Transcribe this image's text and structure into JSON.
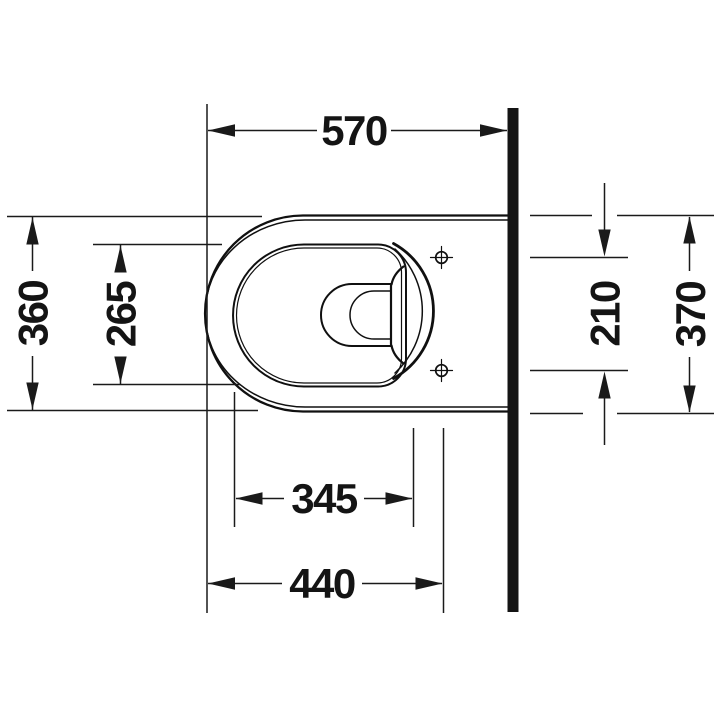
{
  "drawing": {
    "kind": "technical-dimension-drawing",
    "view": "top-view",
    "object": "wall-mounted-toilet"
  },
  "dimensions": {
    "overall_depth_front_to_wall": "570",
    "outer_width": "360",
    "bowl_opening_width": "265",
    "fixing_hole_spacing": "210",
    "width_at_wall": "370",
    "bowl_opening_length": "345",
    "front_to_fixing_holes": "440"
  },
  "colors": {
    "line_ink": "#141414",
    "wall_fill": "#141414",
    "background": "#ffffff"
  }
}
